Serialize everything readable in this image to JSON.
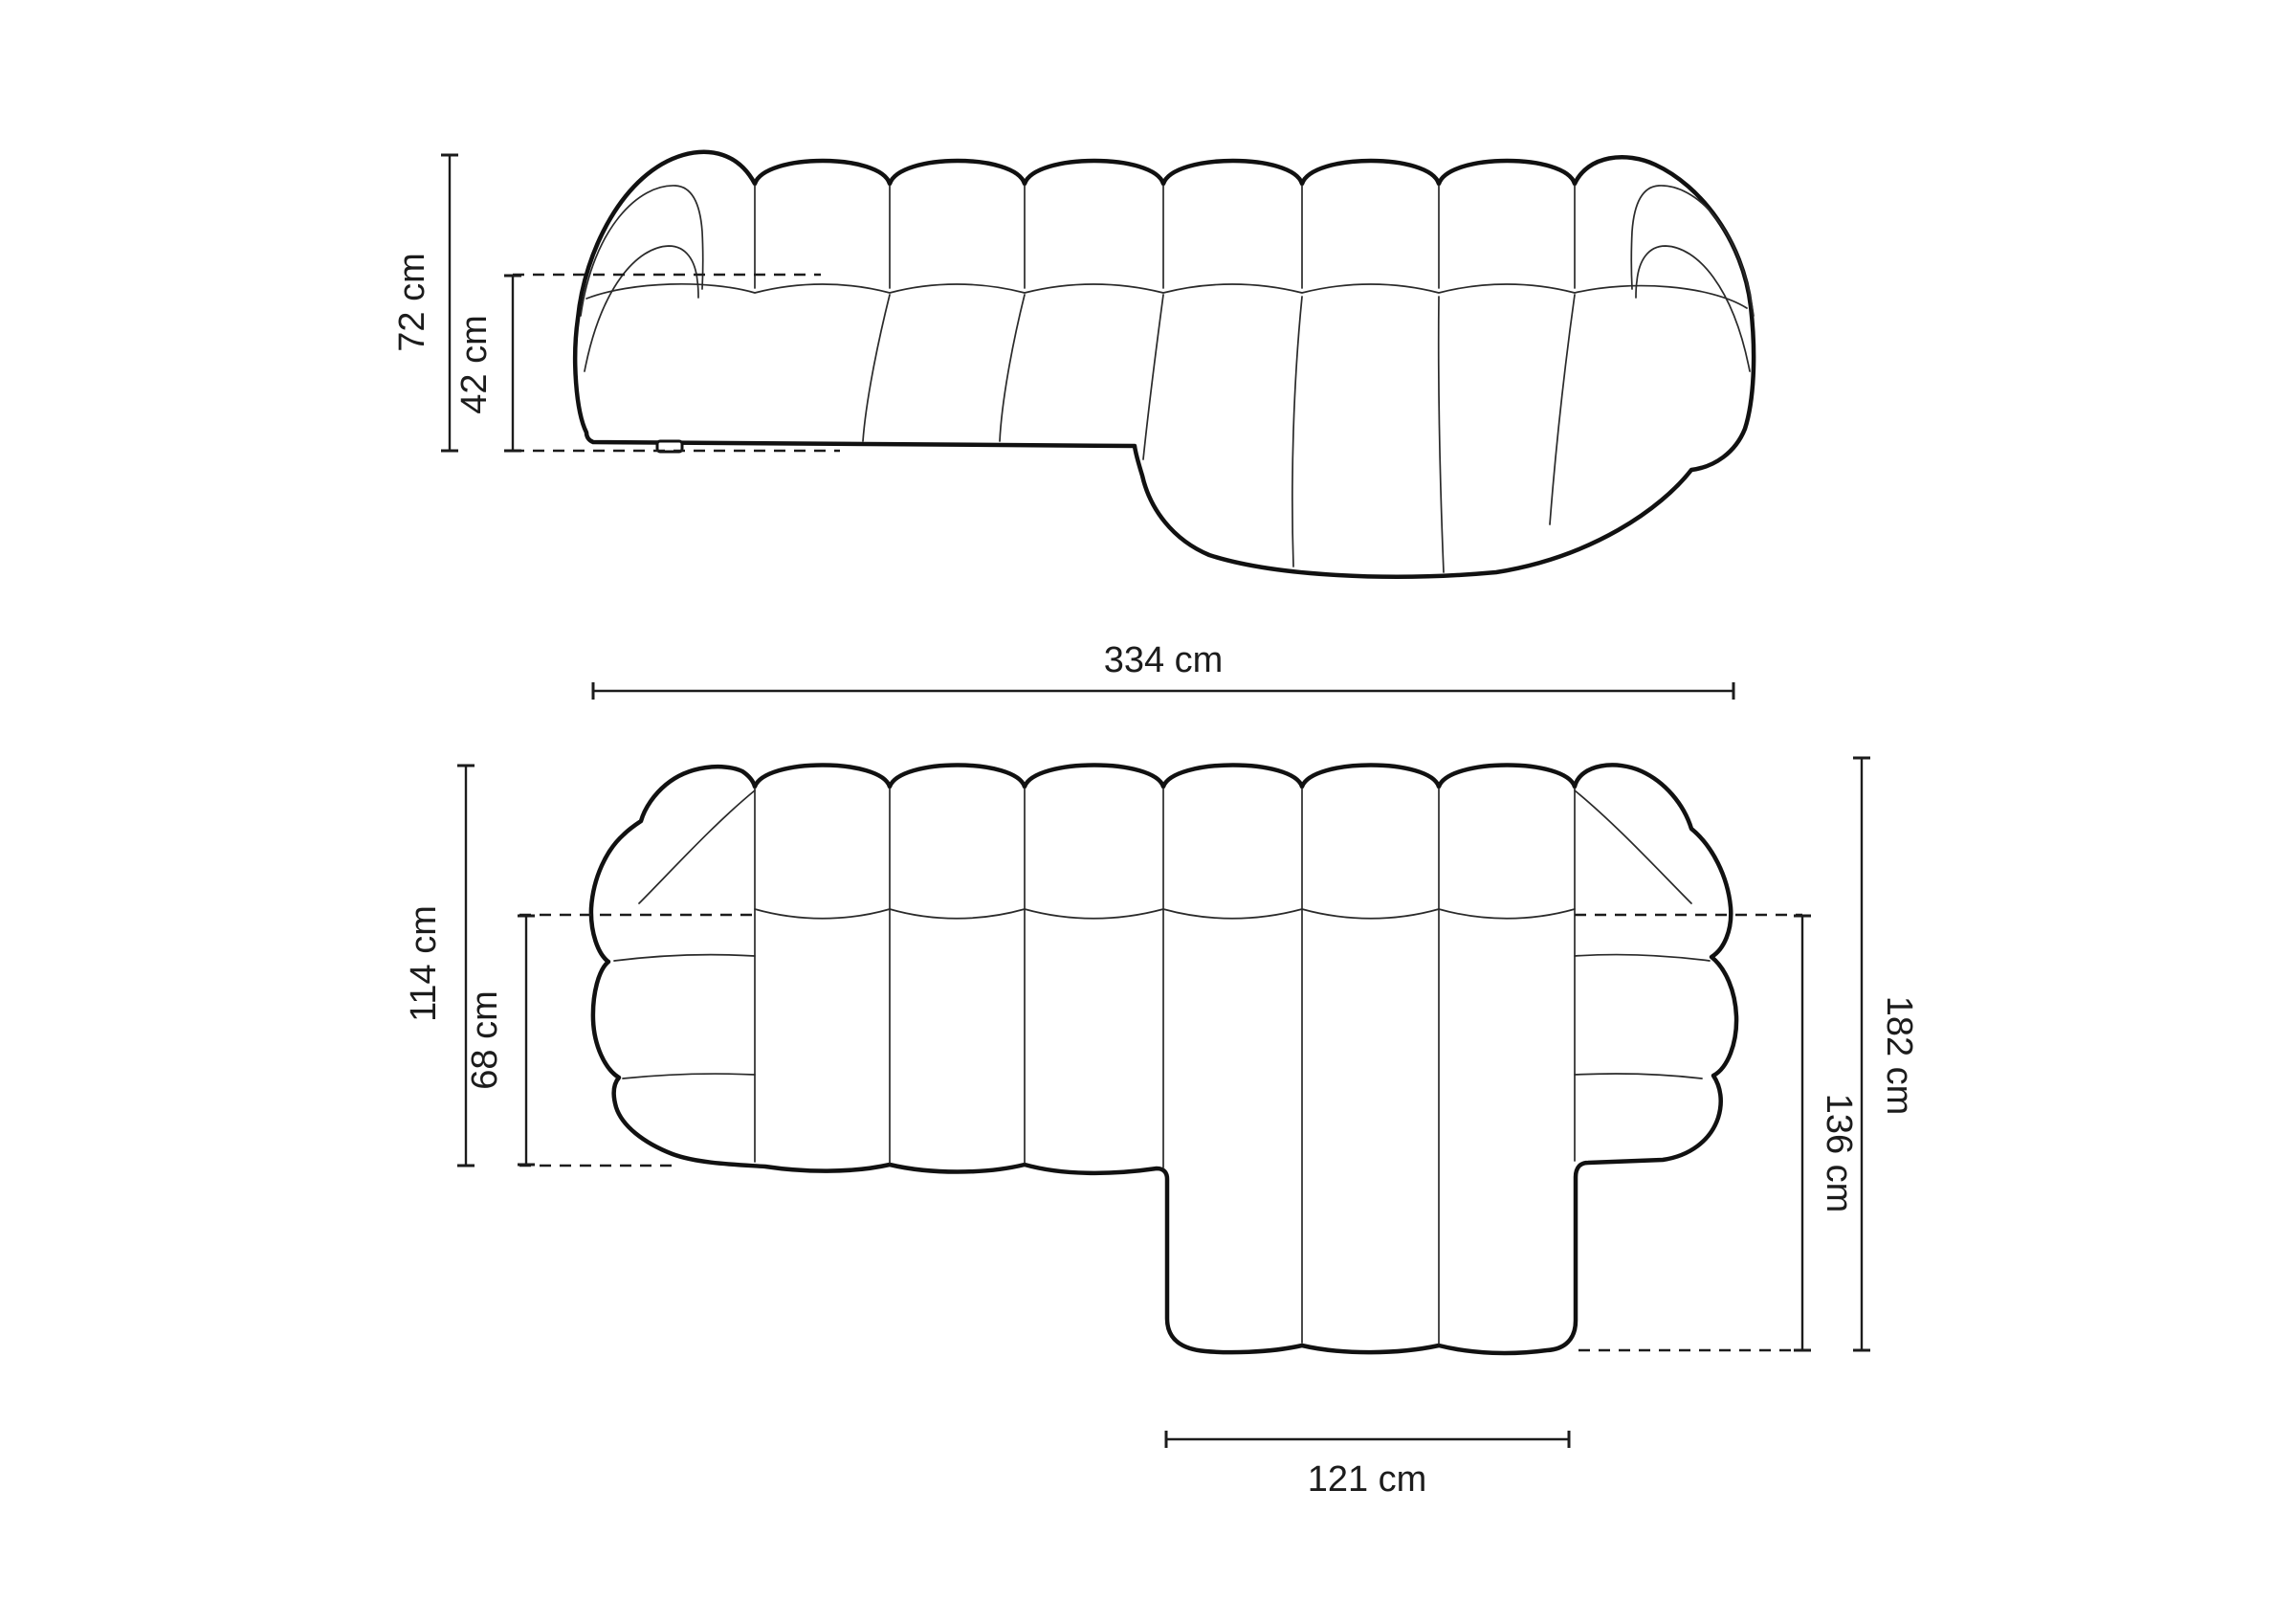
{
  "page": {
    "background": "#ffffff",
    "line_color": "#111111",
    "annotation_color": "#1c1c1c",
    "unit": "cm"
  },
  "views": {
    "front": {
      "name": "front-elevation-view",
      "dimensions": {
        "total_height": {
          "label": "72 cm",
          "value": 72,
          "unit": "cm"
        },
        "seat_height": {
          "label": "42 cm",
          "value": 42,
          "unit": "cm"
        },
        "total_width": {
          "label": "334 cm",
          "value": 334,
          "unit": "cm"
        }
      }
    },
    "top": {
      "name": "top-plan-view",
      "dimensions": {
        "body_depth": {
          "label": "114 cm",
          "value": 114,
          "unit": "cm"
        },
        "seat_depth": {
          "label": "68 cm",
          "value": 68,
          "unit": "cm"
        },
        "total_depth": {
          "label": "182 cm",
          "value": 182,
          "unit": "cm"
        },
        "chaise_depth": {
          "label": "136 cm",
          "value": 136,
          "unit": "cm"
        },
        "chaise_width": {
          "label": "121 cm",
          "value": 121,
          "unit": "cm"
        }
      }
    }
  }
}
